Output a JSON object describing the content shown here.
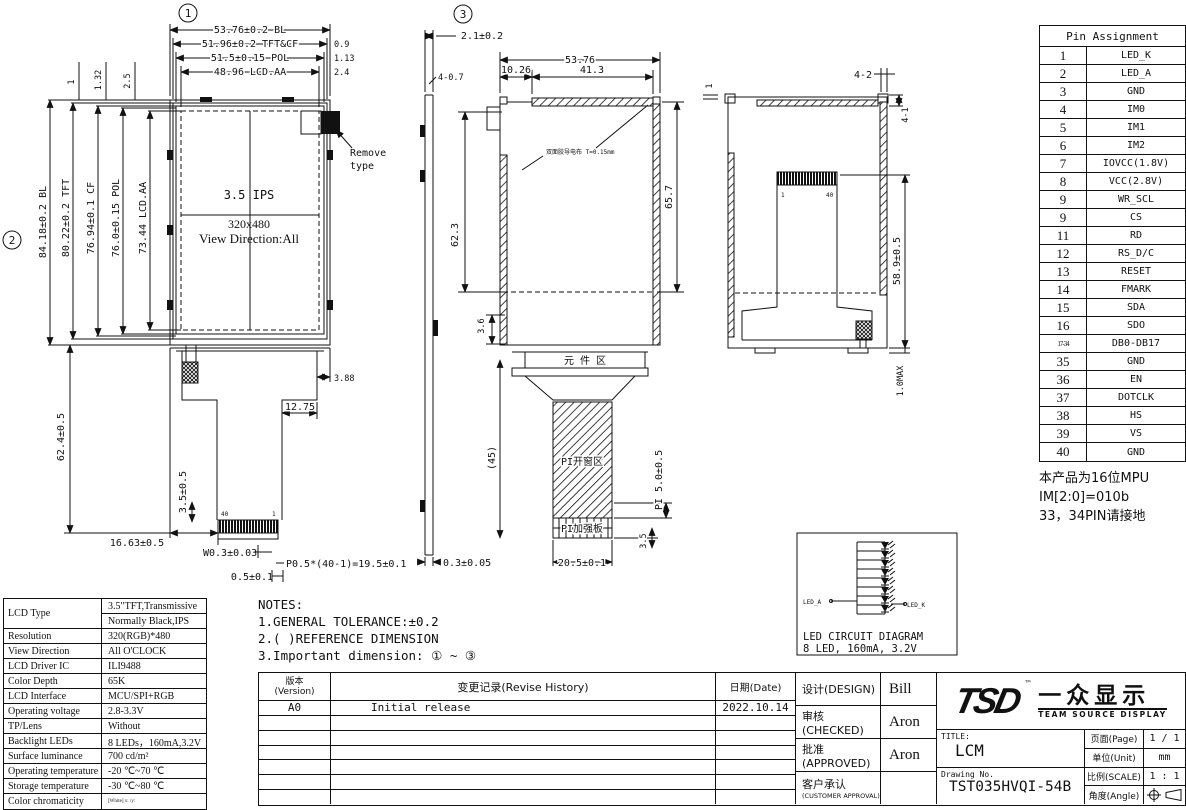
{
  "front_view": {
    "circle_label": "1",
    "left_circle_label": "2",
    "top_dims": [
      "53.76±0.2 BL",
      "51.96±0.2 TFT&CF",
      "51.5±0.15 POL",
      "48.96 LCD.AA"
    ],
    "top_offsets": [
      "0.9",
      "1.13",
      "2.4"
    ],
    "top_left_dims": [
      "1",
      "1.32",
      "2.5"
    ],
    "left_dims": [
      "84.18±0.2 BL",
      "80.22±0.2 TFT",
      "76.94±0.1 CF",
      "76.0±0.15 POL",
      "73.44 LCD.AA"
    ],
    "panel_label_1": "3.5 IPS",
    "panel_label_2": "320x480",
    "panel_label_3": "View Direction:All",
    "remove_note_line1": "Remove",
    "remove_note_line2": "type",
    "left_height_dim": "62.4±0.5",
    "step_dim": "3.88",
    "step_width_dim": "12.75",
    "tail_side_dim": "3.5±0.5",
    "bottom_left_dim": "16.63±0.5",
    "pin_width_dim": "W0.3±0.03",
    "pitch_dim": "P0.5*(40-1)=19.5±0.1",
    "pin_margin_dim": "0.5±0.1",
    "pin_first": "40",
    "pin_last": "1"
  },
  "section_view": {
    "circle_label": "3",
    "thickness_dim": "2.1±0.2",
    "hole_dim": "4-0.7",
    "width_dim": "53.76",
    "offset_dim": "10.26",
    "tape_width_dim": "41.3",
    "gap_dim": "1",
    "height_dim_right": "65.7",
    "height_dim_left": "62.3",
    "gap_bottom_dim": "3.6",
    "tape_note": "双面胶导电布 T=0.15mm",
    "component_area": "元 件 区",
    "fpc_length_dim": "(45)",
    "pi_window": "PI开窗区",
    "pi_stiffener": "PI加强板",
    "pi_dim": "PI 5.0±0.5",
    "stiffener_dim": "3.5",
    "window_width_dim": "20.5±0.1",
    "strip_dim": "0.3±0.05"
  },
  "back_view": {
    "corner_dim": "4-2",
    "edge_dim": "4-1",
    "height_dim": "58.9±0.5",
    "max_dim": "1.0MAX",
    "pin_first": "1",
    "pin_last": "40"
  },
  "led_diagram": {
    "anode": "LED_A",
    "cathode": "LED_K",
    "title": "LED CIRCUIT DIAGRAM",
    "subtitle": "8 LED, 160mA, 3.2V"
  },
  "pin_table": {
    "title": "Pin Assignment",
    "rows": [
      {
        "p": "1",
        "s": "LED_K"
      },
      {
        "p": "2",
        "s": "LED_A"
      },
      {
        "p": "3",
        "s": "GND"
      },
      {
        "p": "4",
        "s": "IM0"
      },
      {
        "p": "5",
        "s": "IM1"
      },
      {
        "p": "6",
        "s": "IM2"
      },
      {
        "p": "7",
        "s": "IOVCC(1.8V)"
      },
      {
        "p": "8",
        "s": "VCC(2.8V)"
      },
      {
        "p": "9",
        "s": "WR_SCL"
      },
      {
        "p": "9",
        "s": "CS"
      },
      {
        "p": "11",
        "s": "RD"
      },
      {
        "p": "12",
        "s": "RS_D/C"
      },
      {
        "p": "13",
        "s": "RESET"
      },
      {
        "p": "14",
        "s": "FMARK"
      },
      {
        "p": "15",
        "s": "SDA"
      },
      {
        "p": "16",
        "s": "SDO"
      },
      {
        "p": "17-34",
        "s": "DB0-DB17"
      },
      {
        "p": "35",
        "s": "GND"
      },
      {
        "p": "36",
        "s": "EN"
      },
      {
        "p": "37",
        "s": "DOTCLK"
      },
      {
        "p": "38",
        "s": "HS"
      },
      {
        "p": "39",
        "s": "VS"
      },
      {
        "p": "40",
        "s": "GND"
      }
    ]
  },
  "mpu_note": {
    "line1": "本产品为16位MPU",
    "line2": "IM[2:0]=010b",
    "line3": "33，34PIN请接地"
  },
  "spec_table": {
    "lcd_type_label": "LCD Type",
    "lcd_type_value1": "3.5\"TFT,Transmissive",
    "lcd_type_value2": "Normally Black,IPS",
    "rows": [
      {
        "label": "Resolution",
        "value": "320(RGB)*480"
      },
      {
        "label": "View Direction",
        "value": "All O'CLOCK"
      },
      {
        "label": "LCD Driver IC",
        "value": "ILI9488"
      },
      {
        "label": "Color Depth",
        "value": "65K"
      },
      {
        "label": "LCD Interface",
        "value": "MCU/SPI+RGB"
      },
      {
        "label": "Operating voltage",
        "value": "2.8-3.3V"
      },
      {
        "label": "TP/Lens",
        "value": "Without"
      },
      {
        "label": "Backlight LEDs",
        "value": "8 LEDs，160mA,3.2V"
      },
      {
        "label": "Surface luminance",
        "value": "700 cd/m²"
      },
      {
        "label": "Operating temperature",
        "value": "-20 ℃~70 ℃"
      },
      {
        "label": "Storage temperature",
        "value": "-30 ℃~80 ℃"
      },
      {
        "label": "Color chromaticity",
        "value": "[White] x:  /y:"
      }
    ]
  },
  "notes": {
    "title": "NOTES:",
    "line1": "1.GENERAL TOLERANCE:±0.2",
    "line2": "2.(  )REFERENCE DIMENSION",
    "line3": "3.Important dimension: ① ~ ③"
  },
  "revision": {
    "version_label_1": "版本",
    "version_label_2": "(Version)",
    "history_label": "变更记录(Revise History)",
    "date_label": "日期(Date)",
    "row_version": "A0",
    "row_desc": "Initial release",
    "row_date": "2022.10.14"
  },
  "approval": {
    "design_label": "设计(DESIGN)",
    "design_value": "Bill",
    "checked_label": "审核(CHECKED)",
    "checked_value": "Aron",
    "approved_label": "批准(APPROVED)",
    "approved_value": "Aron",
    "customer_label_1": "客户承认",
    "customer_label_2": "(CUSTOMER APPROVAL)",
    "customer_value": ""
  },
  "title_block": {
    "logo_tsd": "TSD",
    "logo_tm": "™",
    "logo_cn": "一众显示",
    "logo_en": "TEAM SOURCE DISPLAY",
    "title_label": "TITLE:",
    "title_value": "LCM",
    "drawing_label": "Drawing No.",
    "drawing_value": "TST035HVQI-54B",
    "page_label": "页面(Page)",
    "page_value": "1 / 1",
    "unit_label": "单位(Unit)",
    "unit_value": "mm",
    "scale_label": "比例(SCALE)",
    "scale_value": "1 : 1",
    "angle_label": "角度(Angle)"
  }
}
